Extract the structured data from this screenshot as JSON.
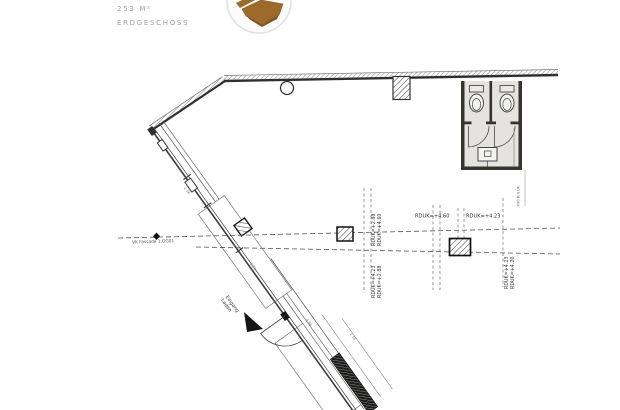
{
  "header": {
    "area_label": "253 M²",
    "floor_label": "ERDGESCHOSS"
  },
  "plan": {
    "labels": {
      "vk_fassade": "VK Fassade 1.OG01",
      "rduk_h1": "RDUK=+4.60",
      "rduk_h2": "RDUK=+4.23",
      "rduk_v1_line1": "RDUK=+2.88",
      "rduk_v1_line2": "RDUK=+4.60",
      "rduk_v2_line1": "RDUK=+4.23",
      "rduk_v2_line2": "RDUK=+2.88",
      "rduk_v3_line1": "RDUK=+4.23",
      "rduk_v3_line2": "RDUK=+4.20",
      "entrance_line1": "Eingang",
      "entrance_line2": "Laden",
      "wall_note": "F90 Brü UK",
      "dims": [
        "2.38",
        "1.01",
        "4.88",
        "1.38"
      ]
    },
    "colors": {
      "line": "#3f3e3c",
      "room_fill": "#e4e3e0",
      "logo_brown": "#9c6a2b",
      "muted_text": "#a49b91"
    }
  }
}
